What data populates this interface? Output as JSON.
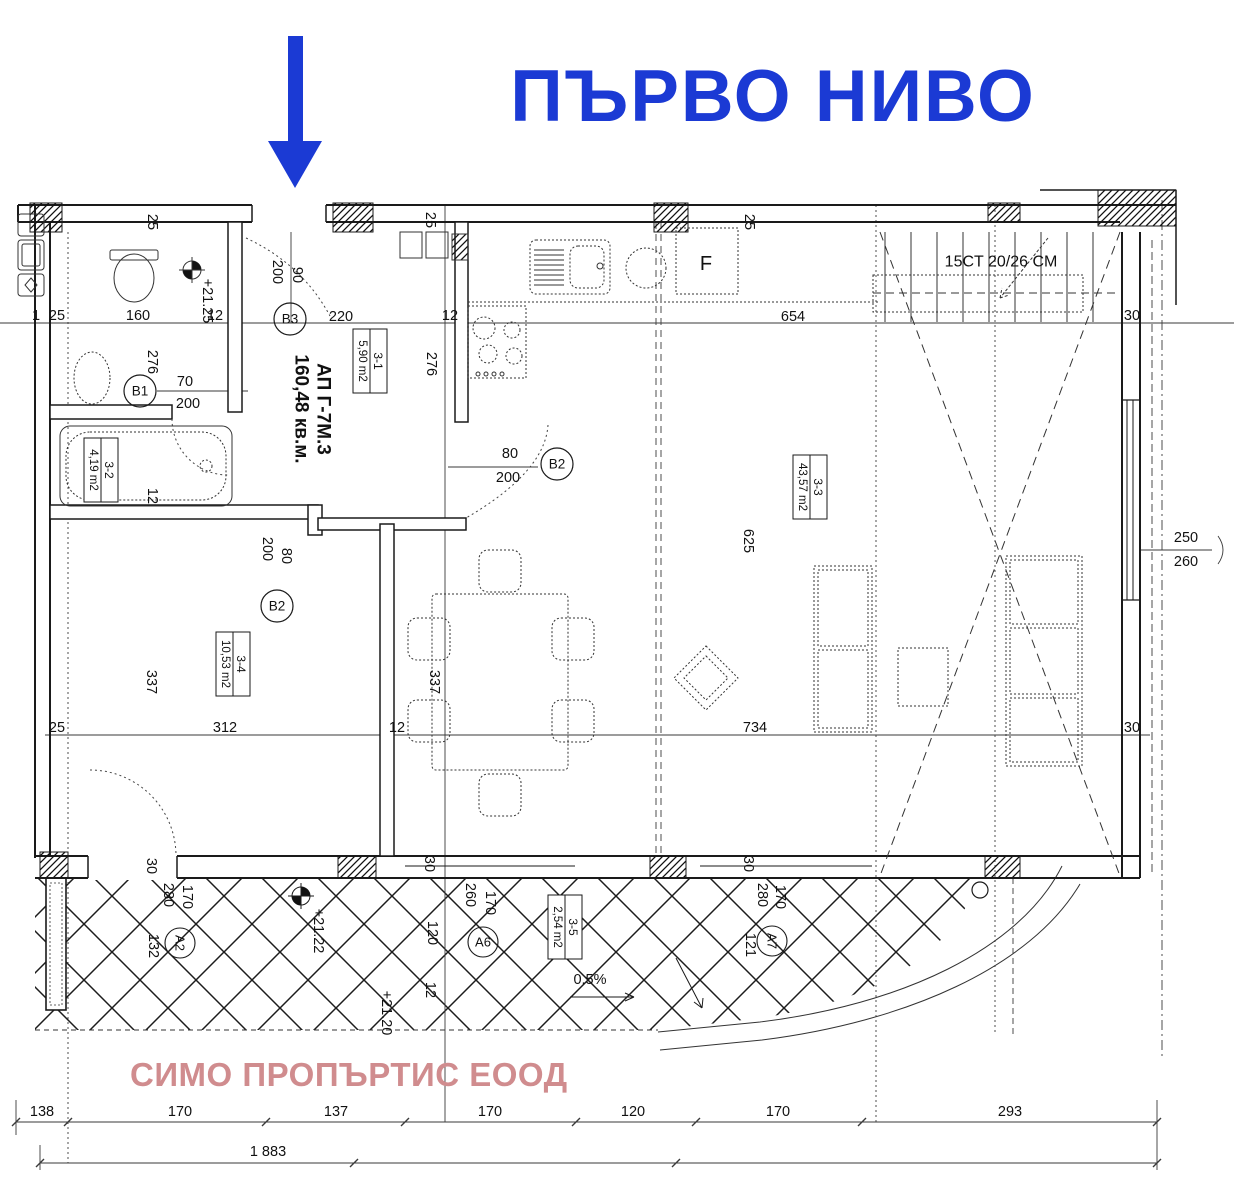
{
  "title": {
    "text": "ПЪРВО НИВО"
  },
  "watermark": {
    "text": "СИМО ПРОПЪРТИС ЕООД"
  },
  "colors": {
    "accent_blue": "#1b3ad4",
    "watermark_pink": "#d08c8e",
    "ink": "#1a1a1a"
  },
  "plan": {
    "apartment_label": {
      "line1": "АП Г-7М.3",
      "line2": "160,48 кв.м.",
      "x": 312,
      "y": 409
    },
    "stair_label": {
      "text": "15CT 20/26 CM",
      "x": 1001,
      "y": 262
    },
    "appliance_labels": [
      {
        "text": "F",
        "x": 706,
        "y": 264
      }
    ],
    "room_boxes": [
      {
        "number": "3-1",
        "area": "5,90 m2",
        "x": 370,
        "y": 361
      },
      {
        "number": "3-2",
        "area": "4,19 m2",
        "x": 101,
        "y": 470
      },
      {
        "number": "3-3",
        "area": "43,57 m2",
        "x": 810,
        "y": 487
      },
      {
        "number": "3-4",
        "area": "10,53 m2",
        "x": 233,
        "y": 664
      },
      {
        "number": "3-5",
        "area": "2,54 m2",
        "x": 565,
        "y": 927
      }
    ],
    "door_markers": [
      {
        "label": "B3",
        "x": 290,
        "y": 319
      },
      {
        "label": "B1",
        "x": 140,
        "y": 391
      },
      {
        "label": "B2",
        "x": 557,
        "y": 464
      },
      {
        "label": "B2",
        "x": 277,
        "y": 606
      }
    ],
    "grid_markers": [
      {
        "label": "A2",
        "x": 180,
        "y": 943,
        "rot": 90
      },
      {
        "label": "A6",
        "x": 483,
        "y": 942
      },
      {
        "label": "A7",
        "x": 772,
        "y": 941,
        "rot": 90
      }
    ],
    "elevation_marks": [
      {
        "text": "+21.25",
        "x": 207,
        "y": 301,
        "rot": 90
      },
      {
        "text": "+21.22",
        "x": 318,
        "y": 931,
        "rot": 90
      },
      {
        "text": "+21.20",
        "x": 386,
        "y": 1013,
        "rot": 90
      }
    ],
    "dimensions": [
      {
        "text": "1",
        "x": 36,
        "y": 316
      },
      {
        "text": "25",
        "x": 57,
        "y": 316
      },
      {
        "text": "160",
        "x": 138,
        "y": 316
      },
      {
        "text": "12",
        "x": 215,
        "y": 316
      },
      {
        "text": "220",
        "x": 341,
        "y": 317
      },
      {
        "text": "12",
        "x": 450,
        "y": 316
      },
      {
        "text": "654",
        "x": 793,
        "y": 317
      },
      {
        "text": "30",
        "x": 1132,
        "y": 316
      },
      {
        "text": "25",
        "x": 152,
        "y": 222,
        "rot": 90
      },
      {
        "text": "200",
        "x": 277,
        "y": 272,
        "rot": 90
      },
      {
        "text": "90",
        "x": 297,
        "y": 275,
        "rot": 90
      },
      {
        "text": "25",
        "x": 430,
        "y": 220,
        "rot": 90
      },
      {
        "text": "25",
        "x": 749,
        "y": 222,
        "rot": 90
      },
      {
        "text": "276",
        "x": 431,
        "y": 364,
        "rot": 90
      },
      {
        "text": "276",
        "x": 152,
        "y": 362,
        "rot": 90
      },
      {
        "text": "70",
        "x": 185,
        "y": 382
      },
      {
        "text": "200",
        "x": 188,
        "y": 404
      },
      {
        "text": "80",
        "x": 510,
        "y": 454
      },
      {
        "text": "200",
        "x": 508,
        "y": 478
      },
      {
        "text": "80",
        "x": 286,
        "y": 556,
        "rot": 90
      },
      {
        "text": "200",
        "x": 267,
        "y": 549,
        "rot": 90
      },
      {
        "text": "12",
        "x": 152,
        "y": 496,
        "rot": 90
      },
      {
        "text": "337",
        "x": 151,
        "y": 682,
        "rot": 90
      },
      {
        "text": "337",
        "x": 434,
        "y": 682,
        "rot": 90
      },
      {
        "text": "625",
        "x": 748,
        "y": 541,
        "rot": 90
      },
      {
        "text": "250",
        "x": 1186,
        "y": 538
      },
      {
        "text": "260",
        "x": 1186,
        "y": 562
      },
      {
        "text": "25",
        "x": 57,
        "y": 728
      },
      {
        "text": "312",
        "x": 225,
        "y": 728
      },
      {
        "text": "12",
        "x": 397,
        "y": 728
      },
      {
        "text": "734",
        "x": 755,
        "y": 728
      },
      {
        "text": "30",
        "x": 1132,
        "y": 728
      },
      {
        "text": "30",
        "x": 151,
        "y": 866,
        "rot": 90
      },
      {
        "text": "280",
        "x": 168,
        "y": 895,
        "rot": 90
      },
      {
        "text": "170",
        "x": 187,
        "y": 897,
        "rot": 90
      },
      {
        "text": "132",
        "x": 153,
        "y": 946,
        "rot": 90
      },
      {
        "text": "30",
        "x": 429,
        "y": 864,
        "rot": 90
      },
      {
        "text": "260",
        "x": 470,
        "y": 895,
        "rot": 90
      },
      {
        "text": "170",
        "x": 490,
        "y": 903,
        "rot": 90
      },
      {
        "text": "120",
        "x": 432,
        "y": 933,
        "rot": 90
      },
      {
        "text": "12",
        "x": 430,
        "y": 990,
        "rot": 90
      },
      {
        "text": "0.5%",
        "x": 590,
        "y": 980
      },
      {
        "text": "30",
        "x": 748,
        "y": 864,
        "rot": 90
      },
      {
        "text": "280",
        "x": 762,
        "y": 895,
        "rot": 90
      },
      {
        "text": "170",
        "x": 780,
        "y": 897,
        "rot": 90
      },
      {
        "text": "121",
        "x": 750,
        "y": 945,
        "rot": 90
      },
      {
        "text": "138",
        "x": 42,
        "y": 1112
      },
      {
        "text": "170",
        "x": 180,
        "y": 1112
      },
      {
        "text": "137",
        "x": 336,
        "y": 1112
      },
      {
        "text": "170",
        "x": 490,
        "y": 1112
      },
      {
        "text": "120",
        "x": 633,
        "y": 1112
      },
      {
        "text": "170",
        "x": 778,
        "y": 1112
      },
      {
        "text": "293",
        "x": 1010,
        "y": 1112
      },
      {
        "text": "1 883",
        "x": 268,
        "y": 1152
      }
    ]
  }
}
